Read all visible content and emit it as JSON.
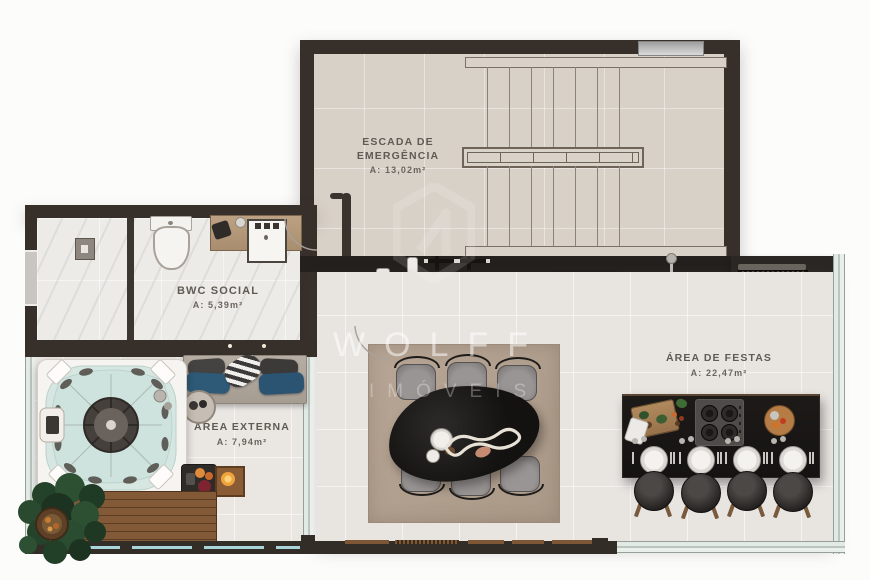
{
  "watermark": {
    "brand": "WOLFF",
    "subtitle": "IMÓVEIS"
  },
  "rooms": {
    "escada": {
      "name_line1": "ESCADA DE",
      "name_line2": "EMERGÊNCIA",
      "area": "A: 13,02m²"
    },
    "bwc": {
      "name": "BWC SOCIAL",
      "area": "A: 5,39m²"
    },
    "externa": {
      "name": "ÁREA EXTERNA",
      "area": "A: 7,94m²"
    },
    "festas": {
      "name": "ÁREA DE FESTAS",
      "area": "A: 22,47m²"
    }
  },
  "colors": {
    "wall": "#372f2a",
    "counter": "#201c1a",
    "label_text": "#5f5a53",
    "water": "#d6e7e2",
    "deck_wood": "#7d5636",
    "rug": "#b3a191",
    "pillow_blue": "#2e5a78",
    "glass": "#bfd8d2",
    "fire": "#e8912f"
  }
}
